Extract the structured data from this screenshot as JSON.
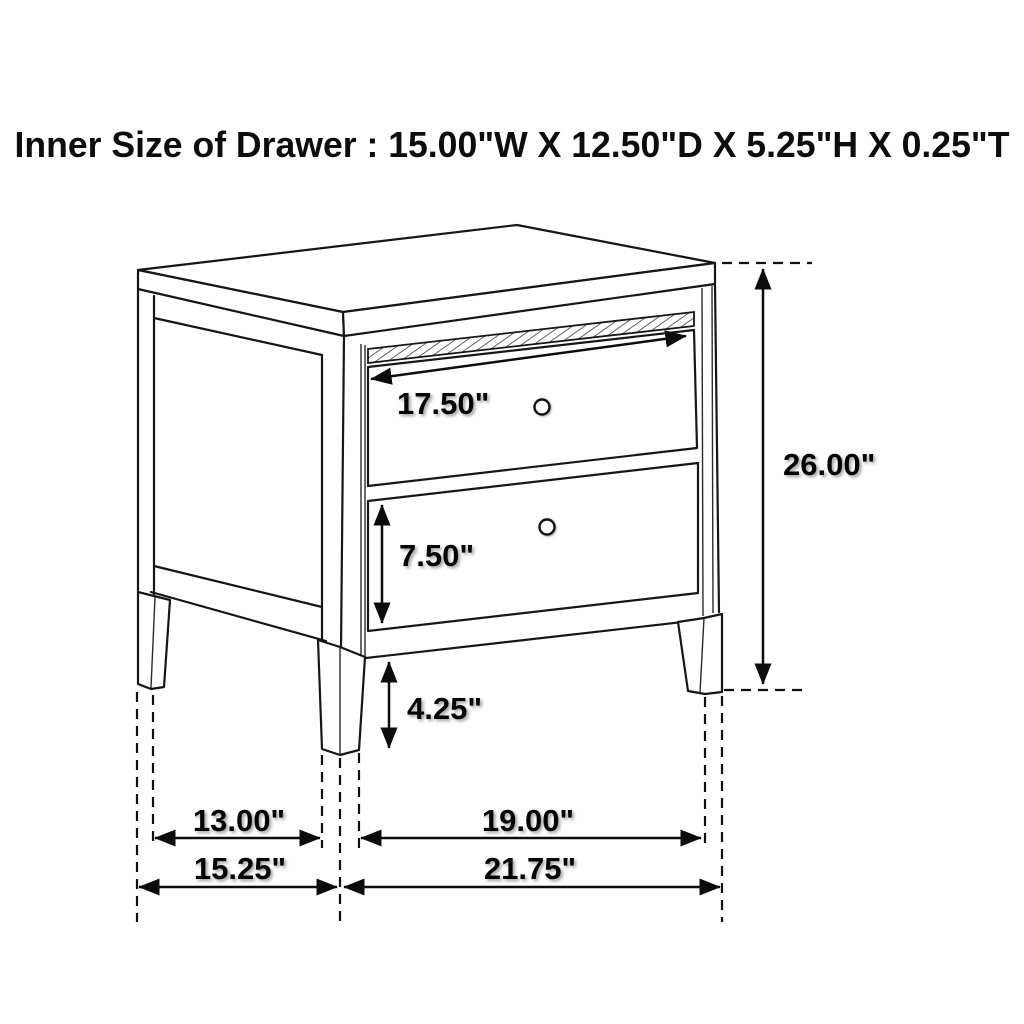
{
  "title": "Inner Size of Drawer : 15.00\"W X 12.50\"D X 5.25\"H X 0.25\"T",
  "dimensions": {
    "top_drawer_width": "17.50\"",
    "overall_height": "26.00\"",
    "bottom_drawer_height": "7.50\"",
    "leg_height": "4.25\"",
    "side_leg_spacing": "13.00\"",
    "side_overall_depth": "15.25\"",
    "front_leg_spacing": "19.00\"",
    "front_overall_width": "21.75\""
  },
  "colors": {
    "background": "#ffffff",
    "line": "#161616",
    "label": "#050505"
  }
}
